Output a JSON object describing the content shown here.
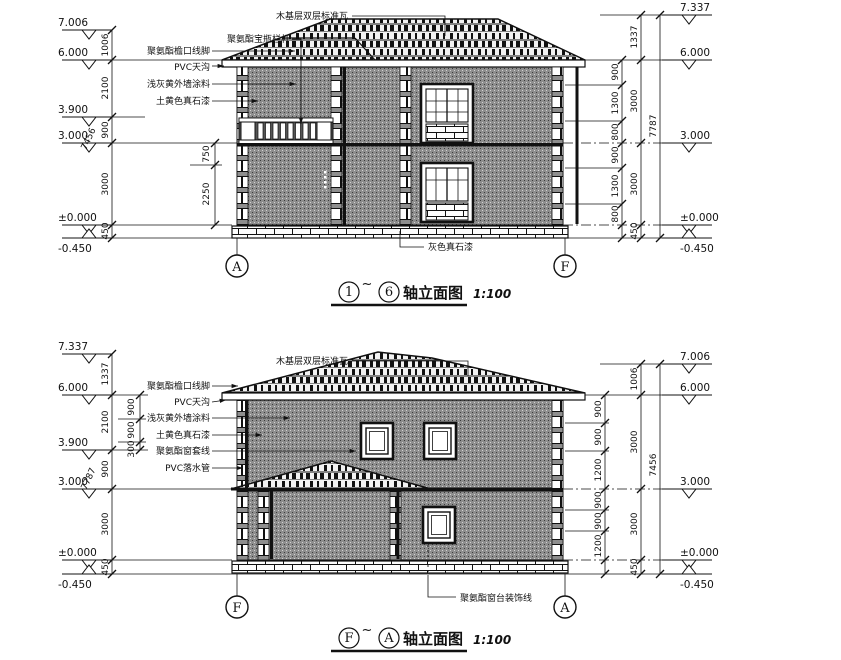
{
  "top": {
    "title": {
      "start": "1",
      "tilde": "~",
      "end": "6",
      "name": "轴立面图",
      "scale": "1:100"
    },
    "bubbles": {
      "left": "A",
      "right": "F"
    },
    "levels_left": [
      "7.006",
      "6.000",
      "3.900",
      "3.000",
      "±0.000",
      "-0.450"
    ],
    "levels_right": [
      "7.337",
      "6.000",
      "3.000",
      "±0.000",
      "-0.450"
    ],
    "chain_left": [
      "1006",
      "2100",
      "900",
      "3000",
      "450"
    ],
    "chain_left_total": "7456",
    "chain_left_inner": [
      "750",
      "2250"
    ],
    "chain_right_inner": [
      "900",
      "1300",
      "800",
      "900",
      "1300",
      "800"
    ],
    "chain_right_mid": [
      "1337",
      "3000",
      "3000",
      "450"
    ],
    "chain_right_total": "7787",
    "ann": {
      "roof": "木基层双层标准瓦",
      "baluster": "聚氨酯宝瓶栏杆",
      "eave": "聚氨酯檐口线脚",
      "gutter": "PVC天沟",
      "wall": "浅灰黄外墙涂料",
      "stone": "土黄色真石漆",
      "plinth": "灰色真石漆"
    }
  },
  "bottom": {
    "title": {
      "start": "F",
      "tilde": "~",
      "end": "A",
      "name": "轴立面图",
      "scale": "1:100"
    },
    "bubbles": {
      "left": "F",
      "right": "A"
    },
    "levels_left": [
      "7.337",
      "6.000",
      "3.900",
      "3.000",
      "±0.000",
      "-0.450"
    ],
    "levels_right": [
      "7.006",
      "6.000",
      "3.000",
      "±0.000",
      "-0.450"
    ],
    "chain_left": [
      "1337",
      "2100",
      "900",
      "3000",
      "450"
    ],
    "chain_left_total": "7787",
    "chain_left_inner": [
      "900",
      "900",
      "300"
    ],
    "chain_right_inner": [
      "900",
      "900",
      "1200",
      "900",
      "900",
      "1200"
    ],
    "chain_right_mid": [
      "1006",
      "3000",
      "3000",
      "450"
    ],
    "chain_right_total": "7456",
    "ann": {
      "roof": "木基层双层标准瓦",
      "eave": "聚氨酯檐口线脚",
      "gutter": "PVC天沟",
      "wall": "浅灰黄外墙涂料",
      "stone": "土黄色真石漆",
      "window": "聚氨酯窗套线",
      "pipe": "PVC落水管",
      "sill": "聚氨酯窗台装饰线"
    }
  }
}
